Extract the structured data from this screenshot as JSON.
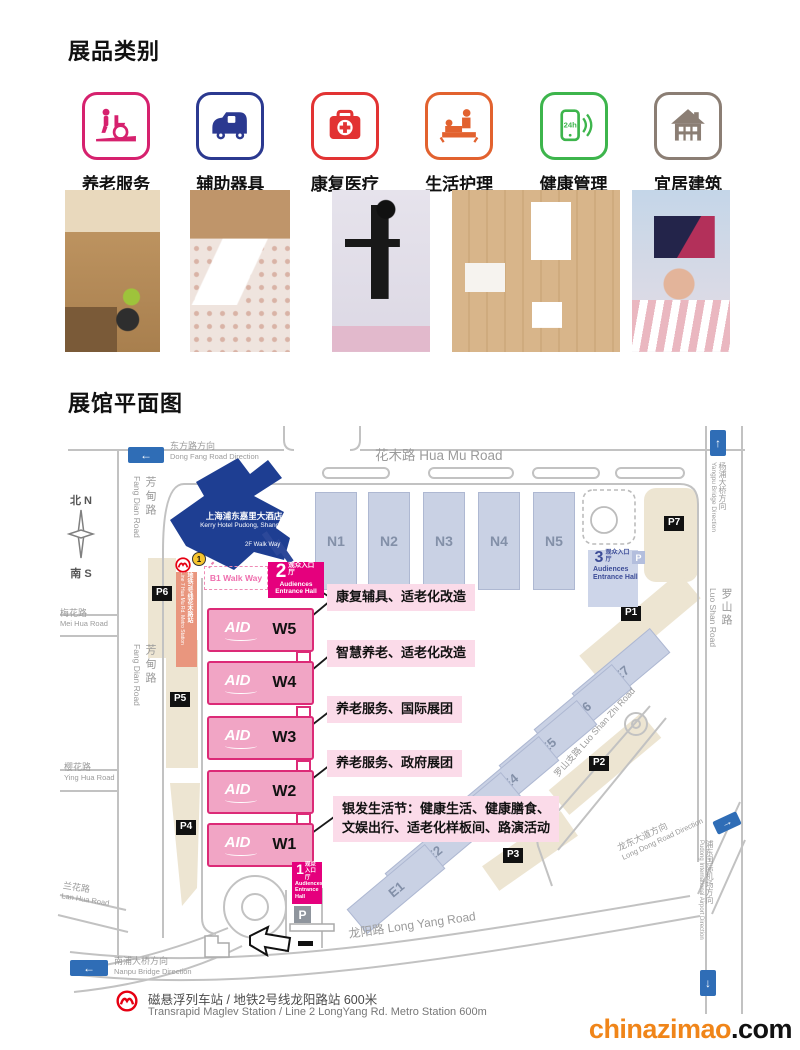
{
  "titles": {
    "products": "展品类别",
    "floorplan": "展馆平面图"
  },
  "categories": [
    {
      "label": "养老服务",
      "color": "#d6216e",
      "icon": "eldercare-wheelchair-icon"
    },
    {
      "label": "辅助器具",
      "color": "#2b3990",
      "icon": "assistive-vehicle-icon"
    },
    {
      "label": "康复医疗",
      "color": "#e23333",
      "icon": "firstaid-kit-icon"
    },
    {
      "label": "生活护理",
      "color": "#e2622f",
      "icon": "bedside-care-icon"
    },
    {
      "label": "健康管理",
      "color": "#3db54c",
      "icon": "phone-24h-icon"
    },
    {
      "label": "宜居建筑",
      "color": "#8b7e74",
      "icon": "house-icon"
    }
  ],
  "photos": [
    {
      "name": "accessible-kitchen-photo"
    },
    {
      "name": "adjustable-bed-photo"
    },
    {
      "name": "exoskeleton-robot-photo"
    },
    {
      "name": "accessible-bathroom-photo"
    },
    {
      "name": "vr-headset-visitor-photo"
    }
  ],
  "map": {
    "directions": {
      "dongfang_cn": "东方路方向",
      "dongfang_en": "Dong Fang Road Direction",
      "yangpu_cn": "杨浦大桥方向",
      "yangpu_en": "Yangpu Bridge Direction",
      "nanpu_cn": "南浦大桥方向",
      "nanpu_en": "Nanpu Bridge Direction",
      "longdong_cn": "龙东大道方向",
      "longdong_en": "Long Dong Road Direction",
      "airport_cn": "浦东国际机场方向",
      "airport_en": "Pudong International Airport Direction"
    },
    "roads": {
      "huamu": "花木路 Hua Mu Road",
      "fangdian_cn": "芳甸路",
      "fangdian_en": "Fang Dian Road",
      "meihua_cn": "梅花路",
      "meihua_en": "Mei Hua Road",
      "yinghua_cn": "樱花路",
      "yinghua_en": "Ying Hua Road",
      "lanhua_cn": "兰花路",
      "lanhua_en": "Lan Hua Road",
      "luoshan_cn": "罗山路",
      "luoshan_en": "Luo Shan Road",
      "luoshanzhi": "罗山支路 Luo Shan Zhi Road",
      "longyang": "龙阳路 Long Yang Road"
    },
    "compass": {
      "north": "北 N",
      "south": "南 S"
    },
    "hotel": {
      "cn": "上海浦东嘉里大酒店",
      "en": "Kerry Hotel Pudong, Shanghai"
    },
    "metro7": {
      "badge": "1",
      "cn": "地铁7号线花木路站",
      "en": "Line 7 Hua Mu Rd. Metro Station"
    },
    "walkways": {
      "b1": "B1 Walk Way",
      "f2": "2F Walk Way"
    },
    "entrances": {
      "audience_cn": "观众入口厅",
      "audience_en": "Audiences Entrance Hall",
      "e1": "1",
      "e2": "2",
      "e3": "3"
    },
    "halls": {
      "aid": "AID",
      "west": [
        "W5",
        "W4",
        "W3",
        "W2",
        "W1"
      ],
      "north": [
        "N1",
        "N2",
        "N3",
        "N4",
        "N5"
      ],
      "east": [
        "E7",
        "E6",
        "E5",
        "E4",
        "E2",
        "E1"
      ]
    },
    "zones": {
      "z5": "康复辅具、适老化改造",
      "z4": "智慧养老、适老化改造",
      "z3": "养老服务、国际展团",
      "z2": "养老服务、政府展团",
      "z1a": "银发生活节：健康生活、健康膳食、",
      "z1b": "文娱出行、适老化样板间、路演活动"
    },
    "parking": {
      "p1": "P1",
      "p2": "P2",
      "p3": "P3",
      "p4": "P4",
      "p5": "P5",
      "p6": "P6",
      "p7": "P7",
      "p": "P"
    },
    "footer": {
      "cn": "磁悬浮列车站 / 地铁2号线龙阳路站 600米",
      "en": "Transrapid Maglev Station / Line 2 LongYang Rd. Metro Station   600m"
    }
  },
  "watermark": {
    "name": "chinazimao",
    "tld": ".com",
    "orange": "#f08519"
  }
}
